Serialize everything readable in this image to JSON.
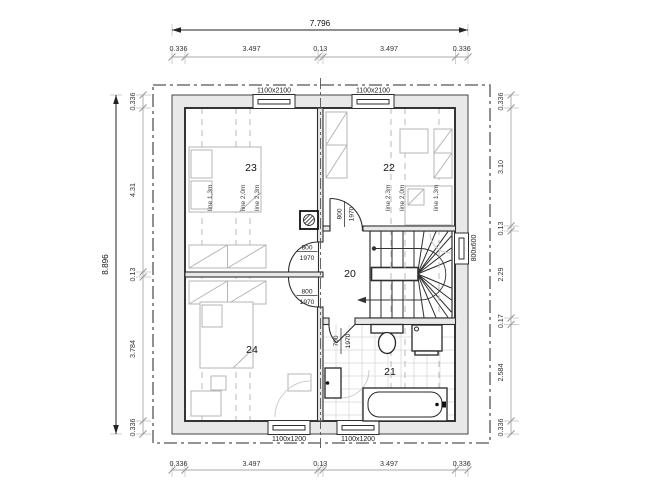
{
  "dimensions": {
    "top": {
      "total": "7.796",
      "segments": [
        "0.336",
        "3.497",
        "0.13",
        "3.497",
        "0.336"
      ]
    },
    "bottom": {
      "segments": [
        "0.336",
        "3.497",
        "0.13",
        "3.497",
        "0.336"
      ]
    },
    "left": {
      "total": "8.896",
      "segments": [
        "0.336",
        "4.31",
        "0.13",
        "3.784",
        "0.336"
      ]
    },
    "right": {
      "segments": [
        "0.336",
        "3.10",
        "0.13",
        "2.29",
        "0.17",
        "2.584",
        "0.336"
      ]
    }
  },
  "windows": {
    "top_left": "1100x2100",
    "top_right": "1100x2100",
    "bottom_left": "1100x1200",
    "bottom_right": "1100x1200",
    "right_niche": "800x600"
  },
  "rooms": {
    "room20": "20",
    "room21": "21",
    "room22": "22",
    "room23": "23",
    "room24": "24"
  },
  "doors": {
    "room23": {
      "width": "800",
      "height": "1970"
    },
    "room24": {
      "width": "800",
      "height": "1970"
    },
    "room22": {
      "width": "800",
      "height": "1970"
    },
    "room21": {
      "width": "700",
      "height": "1970"
    }
  },
  "roof_height_lines": {
    "left_room": [
      "line 1,3m",
      "line 2,0m",
      "line 2,3m"
    ],
    "right_room": [
      "line 2,3m",
      "line 2,0m",
      "line 1,3m"
    ]
  },
  "colors": {
    "wall_fill": "#e8e8e8",
    "line": "#2e2e2e",
    "furniture": "#b5b5b5",
    "dimension": "#999999",
    "tile": "#d8d8d8"
  }
}
